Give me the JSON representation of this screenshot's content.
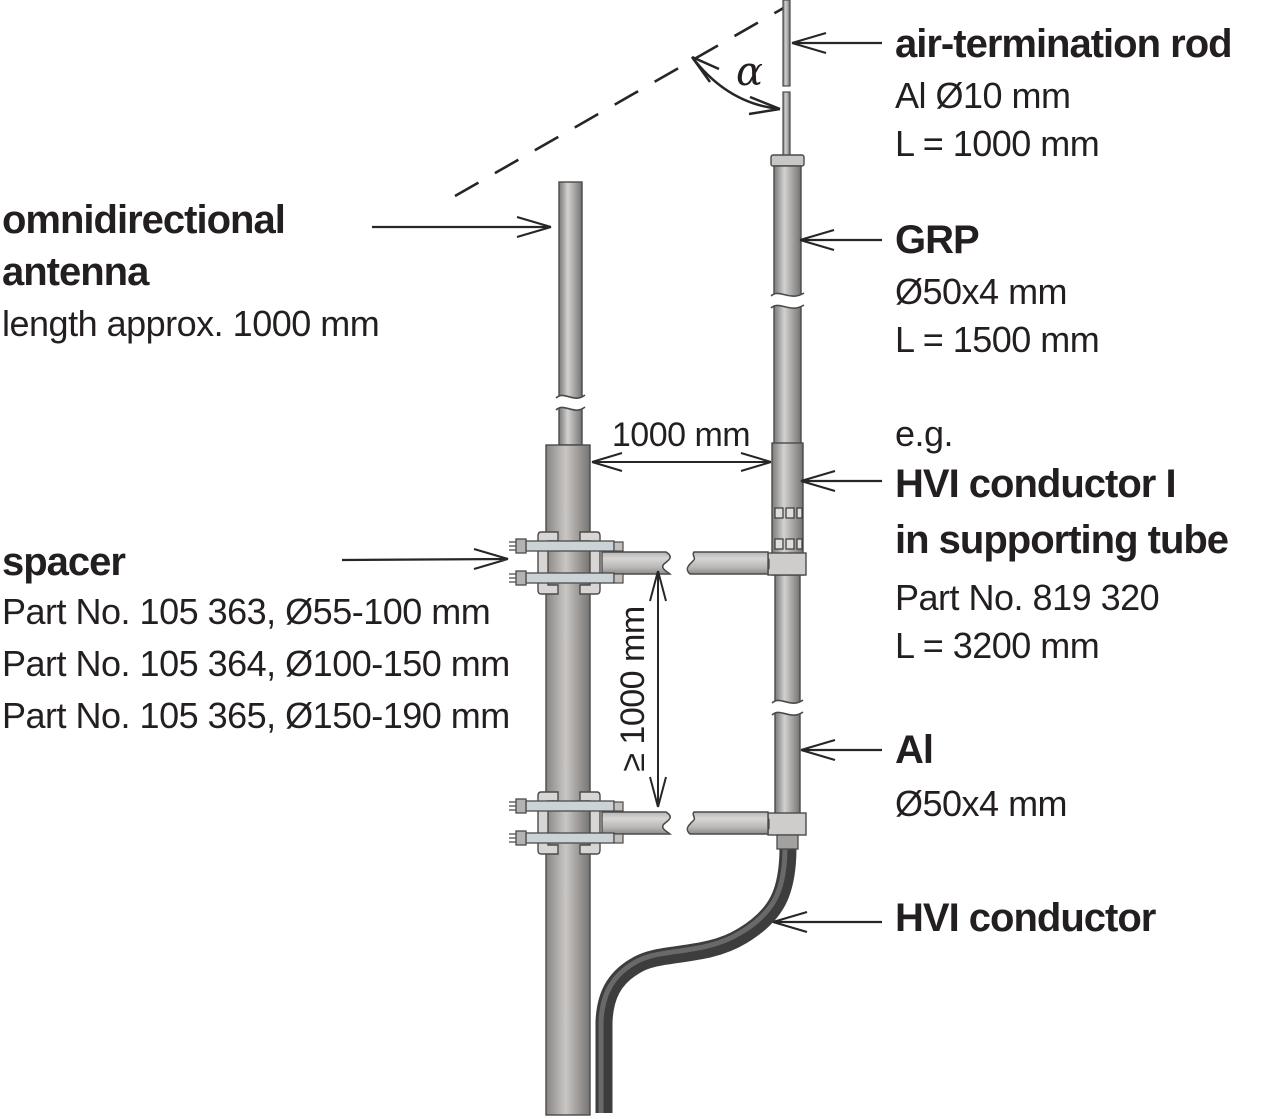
{
  "labels": {
    "antenna": {
      "line1": "omnidirectional",
      "line2": "antenna",
      "detail": "length approx. 1000 mm"
    },
    "spacer": {
      "title": "spacer",
      "part1": "Part No. 105 363, Ø55-100 mm",
      "part2": "Part No. 105 364, Ø100-150 mm",
      "part3": "Part No. 105 365, Ø150-190 mm"
    },
    "air_termination_rod": {
      "title": "air-termination rod",
      "detail1": "Al Ø10 mm",
      "detail2": "L = 1000 mm"
    },
    "grp": {
      "title": "GRP",
      "detail1": "Ø50x4 mm",
      "detail2": "L = 1500 mm"
    },
    "hvi_supporting_tube": {
      "prefix": "e.g.",
      "title1": "HVI conductor I",
      "title2": "in supporting tube",
      "detail1": "Part No. 819 320",
      "detail2": "L = 3200 mm"
    },
    "al_tube": {
      "title": "Al",
      "detail1": "Ø50x4 mm"
    },
    "hvi_conductor": {
      "title": "HVI conductor"
    }
  },
  "dimensions": {
    "spacing_horizontal": "1000 mm",
    "spacing_vertical": "≥ 1000 mm",
    "protection_angle": "α"
  },
  "colors": {
    "text": "#231f20",
    "line": "#262626",
    "tube_highlight": "#d4d2d0",
    "tube_mid": "#aeacaa",
    "tube_edge": "#7c7a78",
    "cable_dark": "#3d3d3d",
    "cable_highlight": "#696969",
    "background": "#ffffff"
  }
}
